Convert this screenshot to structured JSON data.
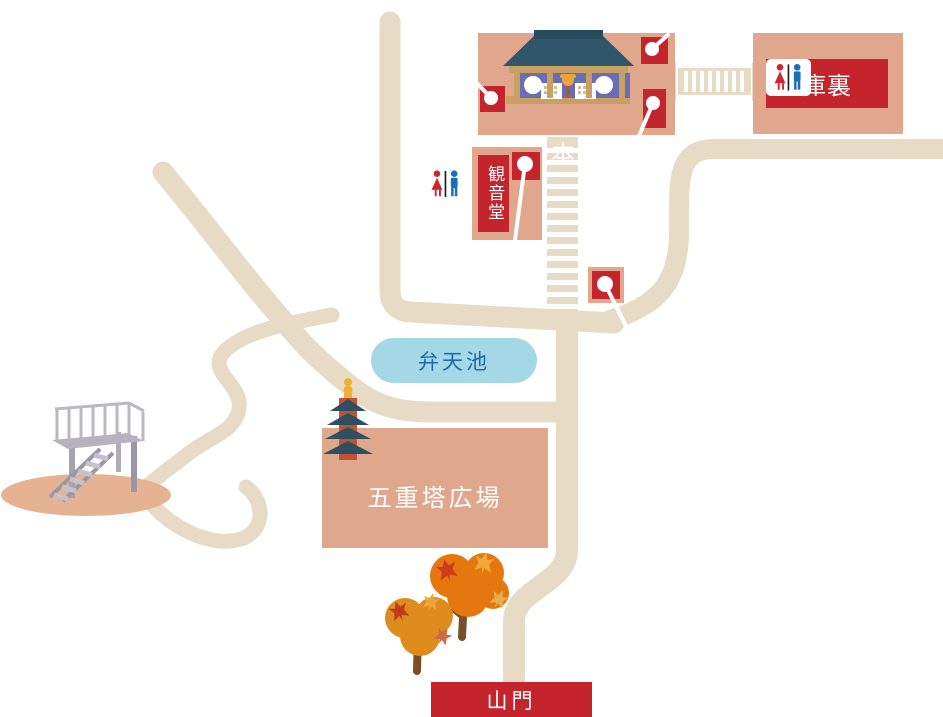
{
  "areas": {
    "main_hall": {
      "label": "本堂"
    },
    "kuri": {
      "label": "庫裏"
    },
    "kannon_hall": {
      "label": "観音堂"
    },
    "benten_pond": {
      "label": "弁天池"
    },
    "pagoda_plaza": {
      "label": "五重塔広場"
    },
    "sanmon_gate": {
      "label": "山門"
    }
  },
  "icons": {
    "map_pin": "photo-spot marker (red square, white pin)",
    "restroom": "male/female restroom pictogram",
    "pagoda": "five-story pagoda",
    "temple": "main hall building",
    "maple_tree": "autumn maple tree",
    "observation_deck": "stairs and viewing platform",
    "stairs": "stone steps",
    "corridor": "connecting corridor"
  },
  "colors": {
    "path_beige": "#e8dbc5",
    "building_tan": "#e0a78c",
    "accent_red": "#c4242c",
    "pond_fill": "#a5d8e6",
    "pond_text": "#1f69a7",
    "roof_teal": "#30566a",
    "pagoda_body": "#bf5434",
    "gold": "#eba53a",
    "label_text": "#ffffff"
  }
}
